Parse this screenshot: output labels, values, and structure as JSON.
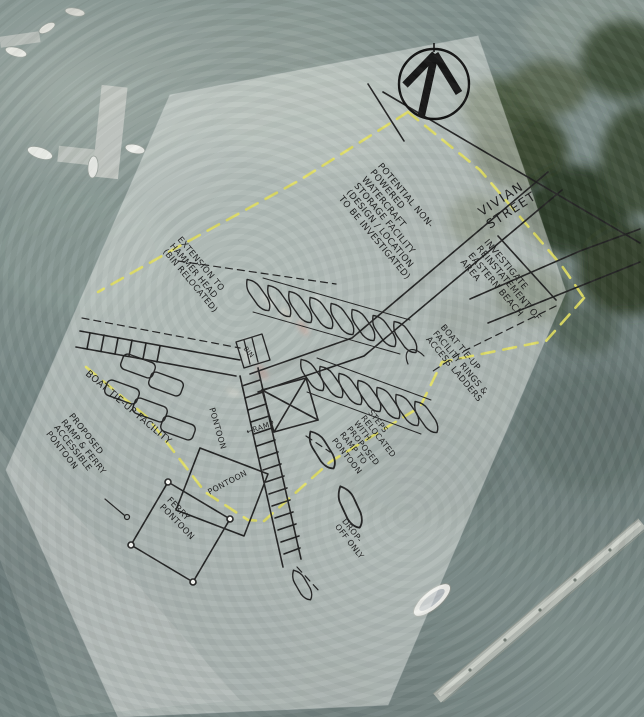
{
  "colors": {
    "ink": "#1f1f1f",
    "boundary_yellow": "#e4e162",
    "paper_white": "#f4f5f1",
    "water_base": "#7f8f8c",
    "foliage_dark": "#36432e"
  },
  "compass": {
    "icon_name": "north-arrow"
  },
  "labels": {
    "street": "VIVIAN STREET",
    "storage": "POTENTIAL NON-POWERED WATERCRAFT STORAGE FACILITY (DESIGN / LOCATION TO BE INVESTIGATED)",
    "extension": "EXTENSION TO HAMMER HEAD (BIN RELOCATED)",
    "eastern_beach": "INVESTIGATE REINSTATEMENT OF EASTERN BEACH AREA",
    "tieup_rings": "BOAT TIE-UP FACILITY RINGS & ACCESS LADDERS",
    "tieup_left": "BOAT TIE-UP FACILITY",
    "proposed_ramp": "PROPOSED RAMP & FERRY ACCESSIBLE PONTOON",
    "steps_relocated": "STEPS RELOCATED WITH PROPOSED RAMP TO PONTOON",
    "drop_off": "DROP-OFF ONLY",
    "ferry_pontoon": "FERRY PONTOON",
    "pontoon_upper": "PONTOON",
    "pontoon_lower": "PONTOON",
    "bin": "BIN",
    "ramp": "RAMP",
    "ramp_arrow": "←"
  }
}
